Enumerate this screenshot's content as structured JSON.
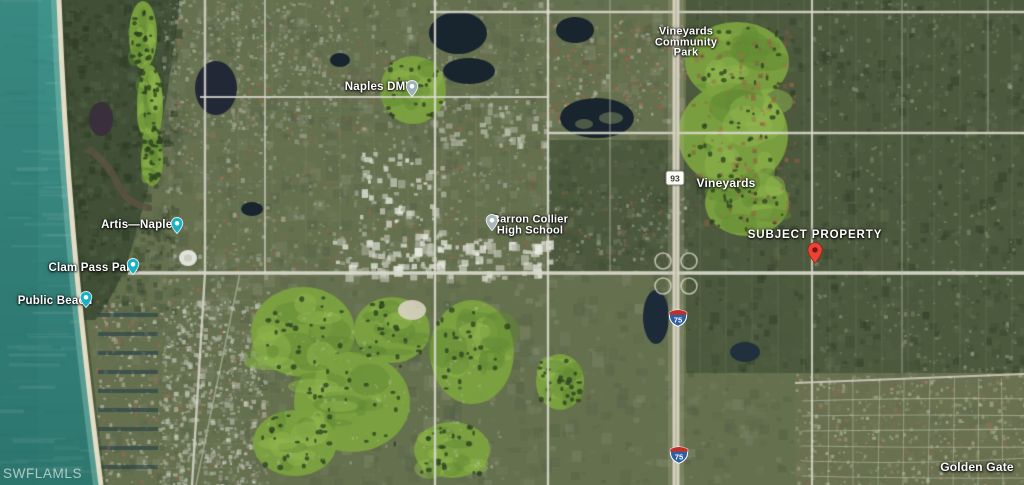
{
  "map": {
    "watermark": "SWFLAMLS",
    "poi_labels": [
      {
        "id": "naples-dmv",
        "text": "Naples DMV"
      },
      {
        "id": "vineyards-community-park",
        "lines": [
          "Vineyards",
          "Community",
          "Park"
        ]
      },
      {
        "id": "artis-naples",
        "text": "Artis—Naples"
      },
      {
        "id": "clam-pass-park",
        "text": "Clam Pass Park"
      },
      {
        "id": "public-beach",
        "text": "Public Beach"
      },
      {
        "id": "barron-collier-high-school",
        "lines": [
          "Barron Collier",
          "High School"
        ]
      },
      {
        "id": "vineyards",
        "text": "Vineyards"
      },
      {
        "id": "golden-gate",
        "text": "Golden Gate"
      }
    ],
    "annotations": [
      {
        "id": "subject-property",
        "text": "SUBJECT PROPERTY"
      }
    ],
    "route_shields": [
      {
        "system": "state-road",
        "number": "93"
      },
      {
        "system": "interstate",
        "number": "75"
      },
      {
        "system": "interstate",
        "number": "75"
      }
    ],
    "markers": [
      {
        "name": "naples-dmv-pin",
        "icon": "government-pin-icon"
      },
      {
        "name": "artis-naples-pin",
        "icon": "attraction-pin-icon"
      },
      {
        "name": "clam-pass-park-pin",
        "icon": "attraction-pin-icon"
      },
      {
        "name": "public-beach-pin",
        "icon": "attraction-pin-icon"
      },
      {
        "name": "barron-collier-high-school-pin",
        "icon": "school-pin-icon"
      },
      {
        "name": "subject-property-pin",
        "icon": "location-pin-icon"
      }
    ]
  },
  "colors": {
    "poi_pin_teal": "#17b1c4",
    "government_pin_slate": "#9fb0ba",
    "school_pin_gray": "#a9b6bc",
    "subject_pin_red": "#ea4335",
    "subject_pin_core": "#7e120d",
    "interstate_blue": "#2e5fa3",
    "interstate_red": "#bf3126",
    "ocean_teal": "#35837b"
  }
}
